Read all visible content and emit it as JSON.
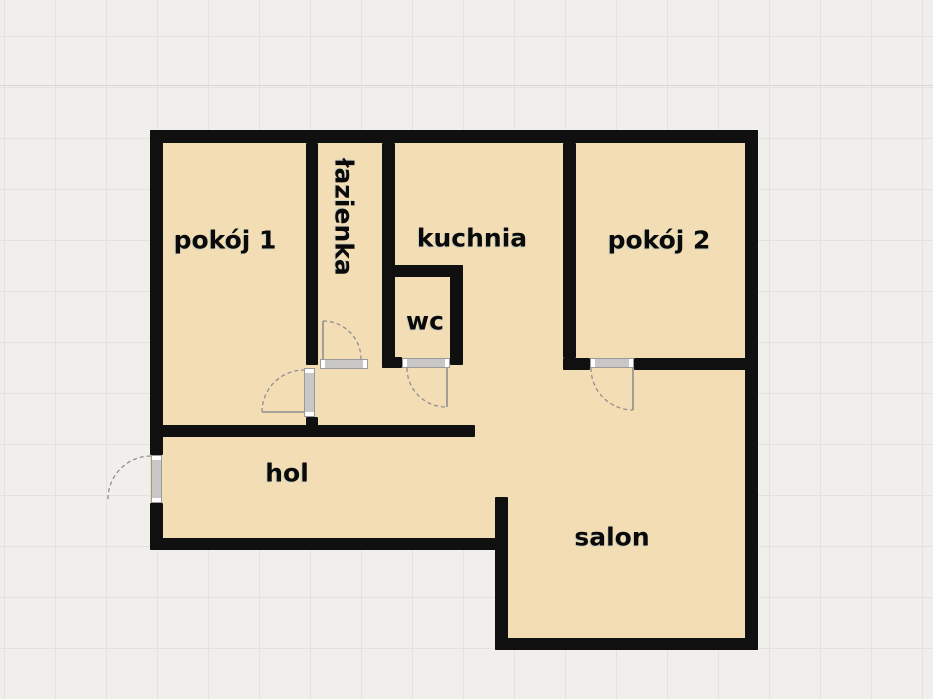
{
  "plan": {
    "rooms": [
      {
        "id": "pokoj1",
        "label": "pokój 1"
      },
      {
        "id": "lazienka",
        "label": "łazienka"
      },
      {
        "id": "kuchnia",
        "label": "kuchnia"
      },
      {
        "id": "wc",
        "label": "wc"
      },
      {
        "id": "pokoj2",
        "label": "pokój 2"
      },
      {
        "id": "hol",
        "label": "hol"
      },
      {
        "id": "salon",
        "label": "salon"
      }
    ],
    "colors": {
      "background": "#f0efec",
      "grid": "#e3e2df",
      "floor": "#f2ddb5",
      "wall": "#101010",
      "door": "#c8c7c5",
      "swing": "#8f8f8f",
      "label": "#0a0a0a"
    }
  }
}
